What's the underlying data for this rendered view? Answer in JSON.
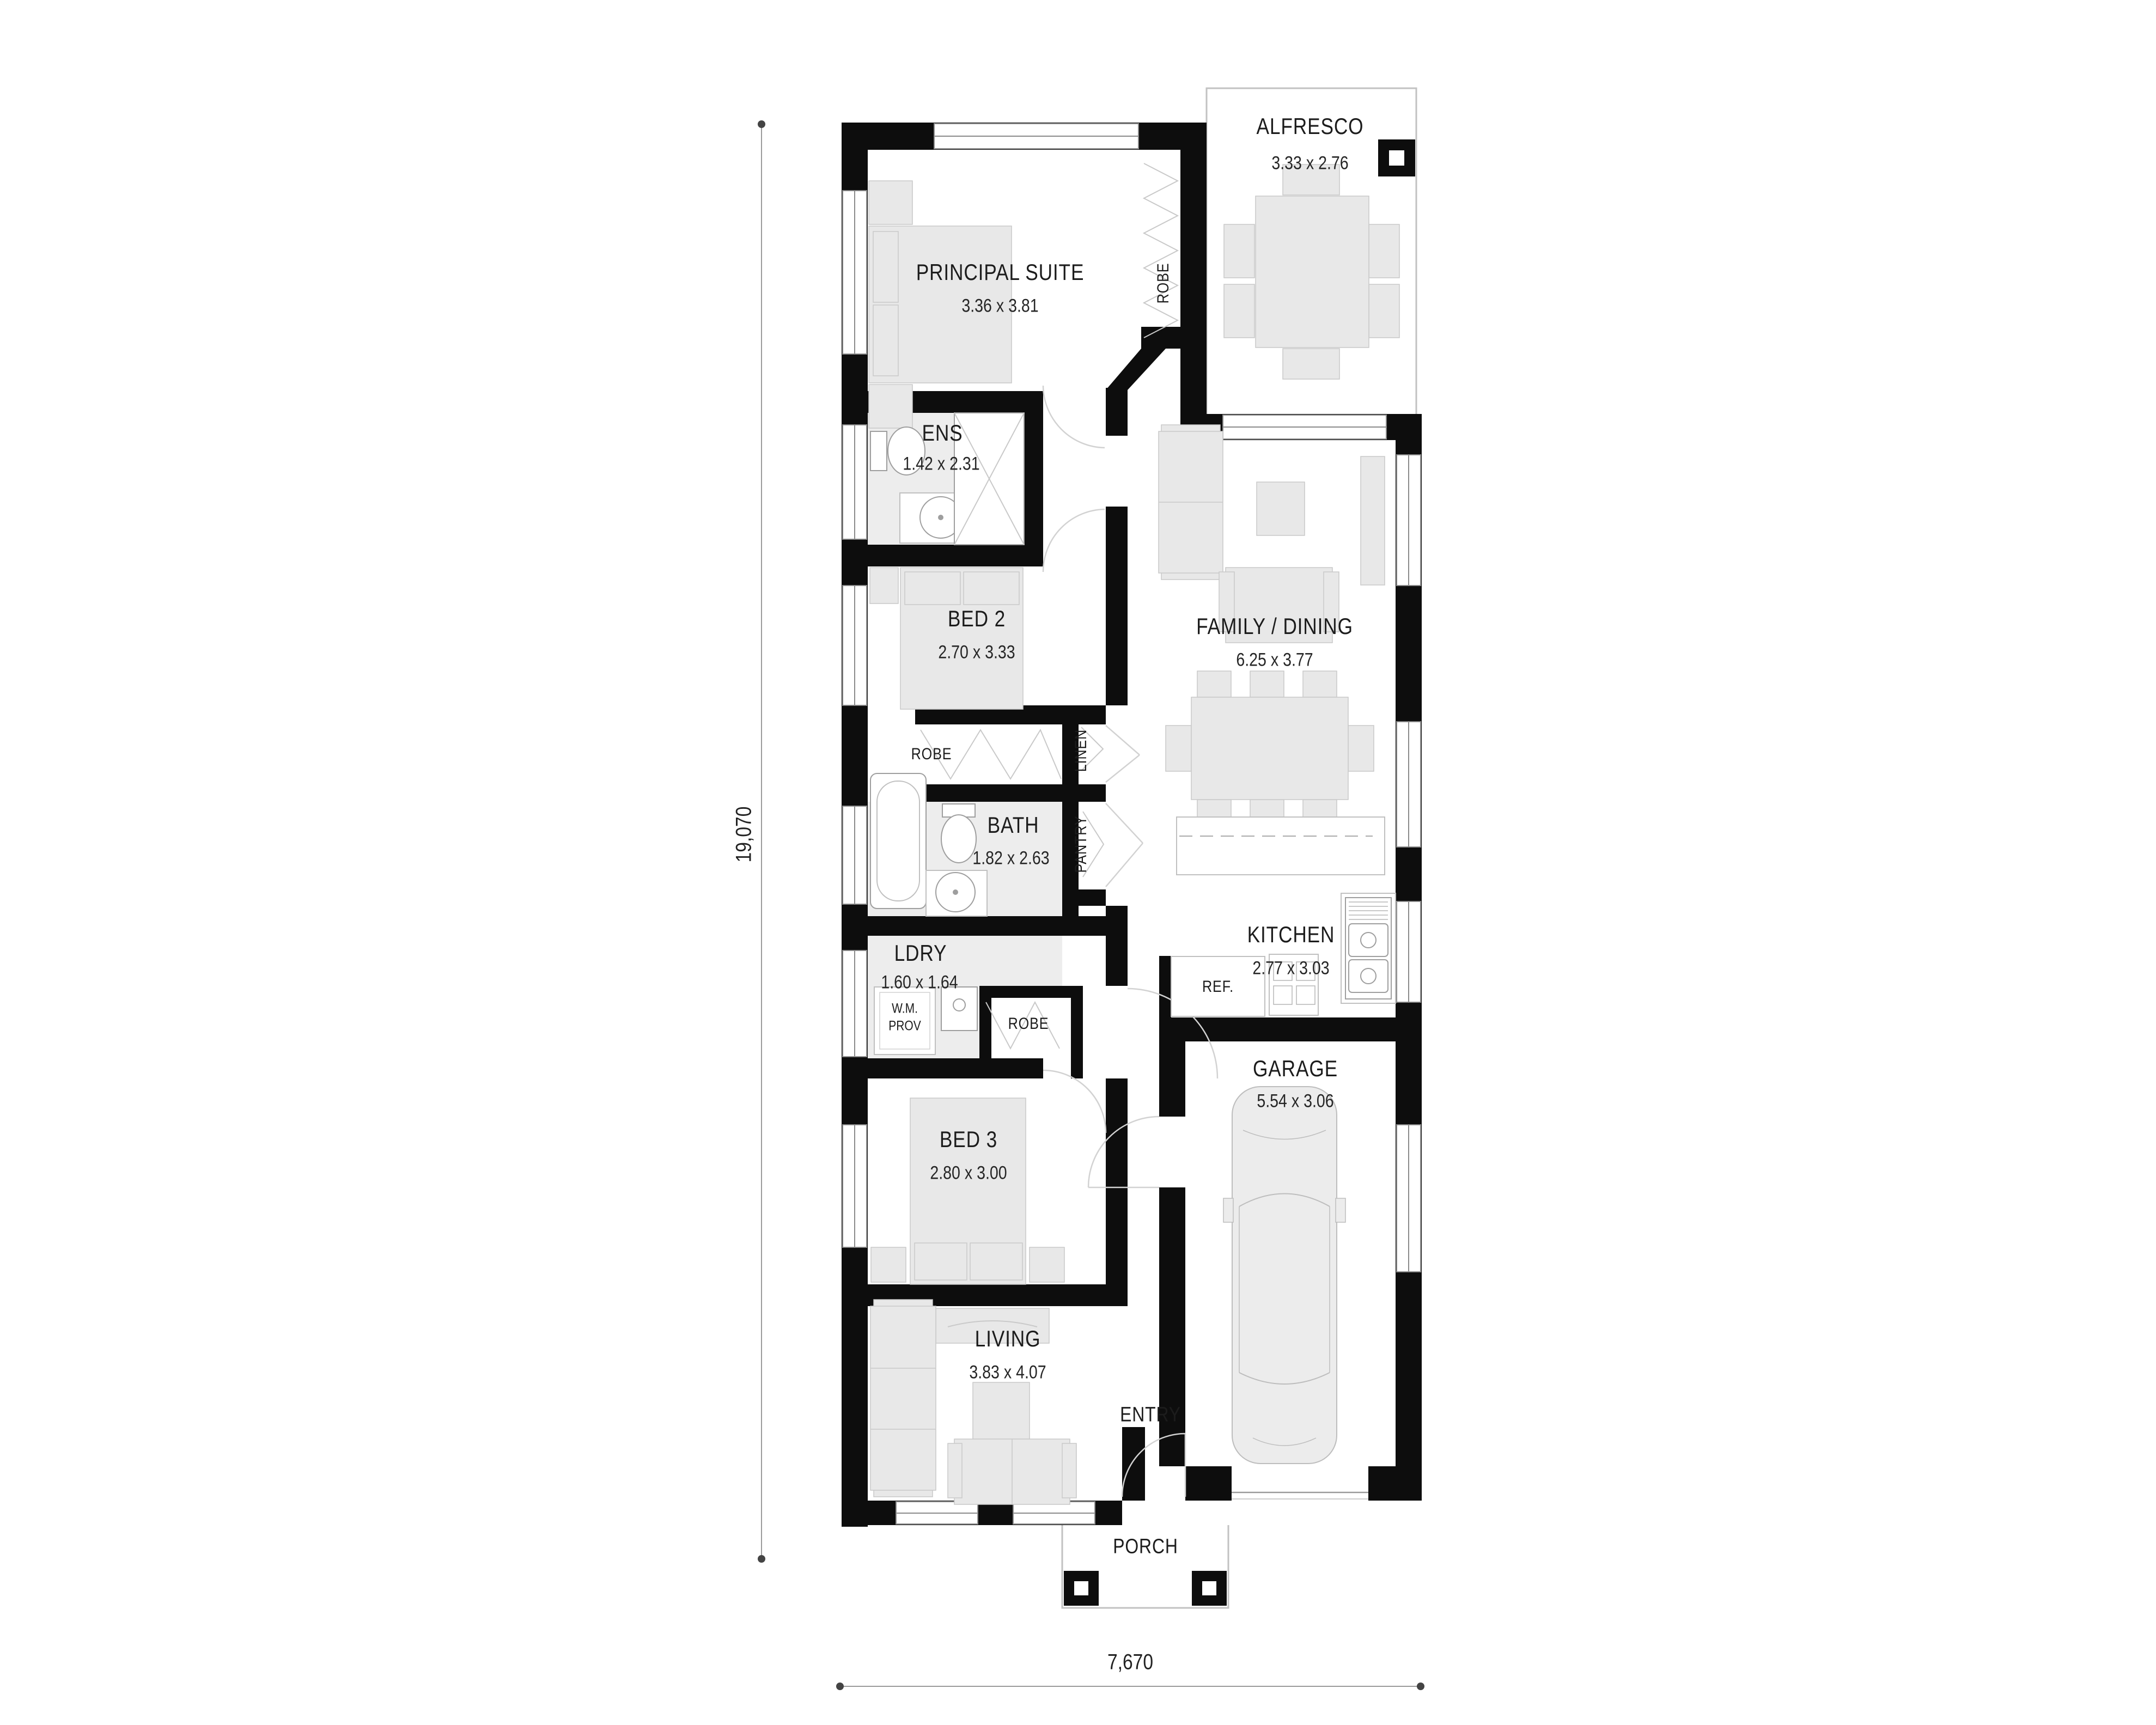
{
  "rooms": {
    "alfresco": {
      "name": "ALFRESCO",
      "dims": "3.33 x 2.76"
    },
    "principal_suite": {
      "name": "PRINCIPAL SUITE",
      "dims": "3.36 x 3.81"
    },
    "ens": {
      "name": "ENS",
      "dims": "1.42 x 2.31"
    },
    "bed2": {
      "name": "BED 2",
      "dims": "2.70 x 3.33"
    },
    "family_dining": {
      "name": "FAMILY / DINING",
      "dims": "6.25 x 3.77"
    },
    "bath": {
      "name": "BATH",
      "dims": "1.82 x 2.63"
    },
    "kitchen": {
      "name": "KITCHEN",
      "dims": "2.77 x 3.03"
    },
    "laundry": {
      "name": "LDRY",
      "dims": "1.60 x 1.64"
    },
    "garage": {
      "name": "GARAGE",
      "dims": "5.54 x 3.06"
    },
    "bed3": {
      "name": "BED 3",
      "dims": "2.80 x 3.00"
    },
    "living": {
      "name": "LIVING",
      "dims": "3.83 x 4.07"
    },
    "entry": {
      "name": "ENTRY"
    },
    "porch": {
      "name": "PORCH"
    }
  },
  "closets": {
    "robe_principal": "ROBE",
    "robe_bed2": "ROBE",
    "robe_bed3": "ROBE",
    "linen": "LINEN",
    "pantry": "PANTRY"
  },
  "fixtures": {
    "fridge": "REF.",
    "wm_line1": "W.M.",
    "wm_line2": "PROV"
  },
  "overall_dimensions": {
    "depth_mm": "19,070",
    "width_mm": "7,670"
  },
  "colors": {
    "wall": "#0d0d0d",
    "room_shade": "#ededed",
    "furniture_fill": "#e8e8e8",
    "furniture_stroke": "#c9c9c9",
    "fixture_stroke": "#9e9e9e",
    "dimension_line": "#9a9a9a",
    "text": "#1c1c1c",
    "background": "#ffffff"
  }
}
